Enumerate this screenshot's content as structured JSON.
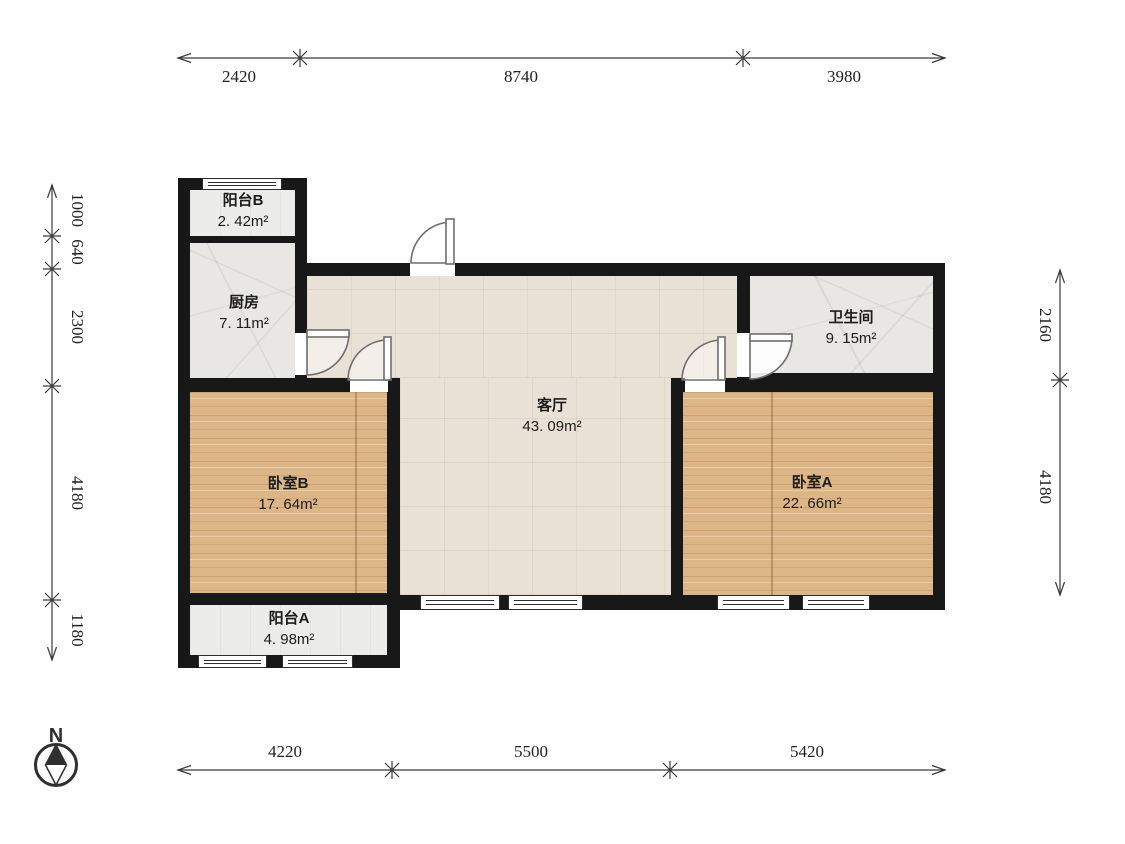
{
  "plan_title": "two-bedroom apartment floor plan",
  "rooms": {
    "balcony_b": {
      "name": "阳台B",
      "area": "2. 42m²"
    },
    "kitchen": {
      "name": "厨房",
      "area": "7. 11m²"
    },
    "living_room": {
      "name": "客厅",
      "area": "43. 09m²"
    },
    "bathroom": {
      "name": "卫生间",
      "area": "9. 15m²"
    },
    "bedroom_b": {
      "name": "卧室B",
      "area": "17. 64m²"
    },
    "bedroom_a": {
      "name": "卧室A",
      "area": "22. 66m²"
    },
    "balcony_a": {
      "name": "阳台A",
      "area": "4. 98m²"
    }
  },
  "dimensions": {
    "top": [
      "2420",
      "8740",
      "3980"
    ],
    "bottom": [
      "4220",
      "5500",
      "5420"
    ],
    "left": [
      "1000",
      "640",
      "2300",
      "4180",
      "1180"
    ],
    "right": [
      "2160",
      "4180"
    ]
  },
  "compass": {
    "north_label": "N"
  },
  "colors": {
    "wall": "#181818",
    "wood_floor": "#dcb687",
    "living_floor": "#eae1d6",
    "tile_floor": "#e8e7e4",
    "balcony_floor": "#ececea",
    "dimension_line": "#3a3a3a"
  }
}
